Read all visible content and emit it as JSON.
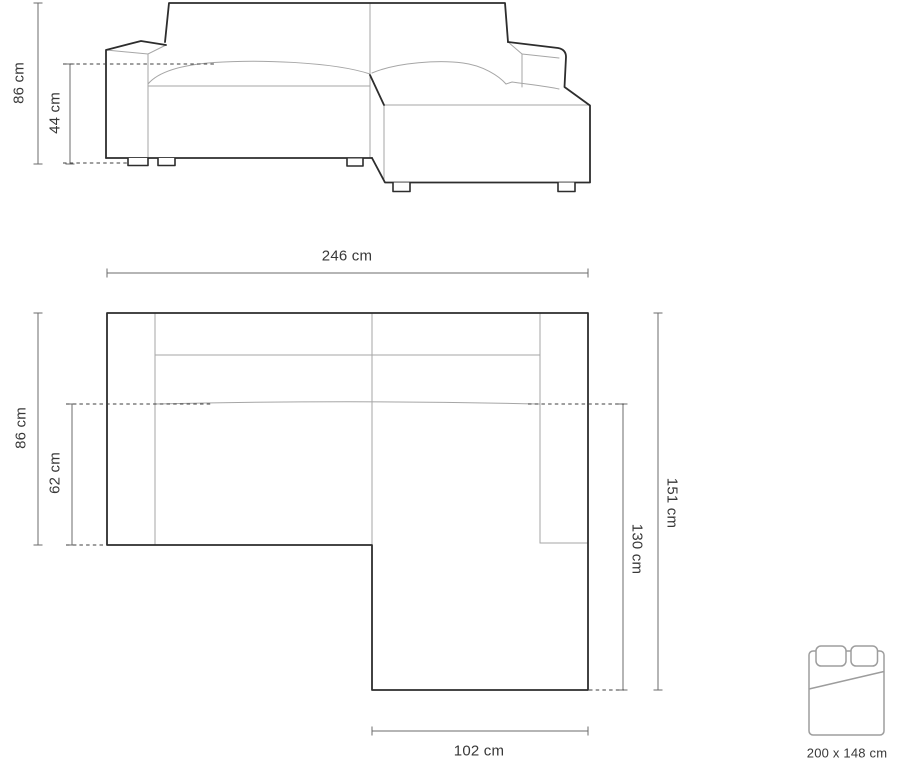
{
  "front_view": {
    "labels": {
      "total_height": "86 cm",
      "seat_height": "44 cm"
    }
  },
  "plan_view": {
    "labels": {
      "total_width": "246 cm",
      "body_depth": "86 cm",
      "seat_depth": "62 cm",
      "total_depth": "151 cm",
      "chaise_depth": "130 cm",
      "chaise_width": "102 cm"
    }
  },
  "bed": {
    "size_label": "200 x 148 cm"
  },
  "colors": {
    "outline_dark": "#2d2d2d",
    "line_light": "#a6a6a6",
    "dimension": "#6b6b6b",
    "dashed": "#3f3f3f",
    "text": "#383838",
    "bed_icon": "#9d9d9d",
    "background": "#ffffff"
  }
}
